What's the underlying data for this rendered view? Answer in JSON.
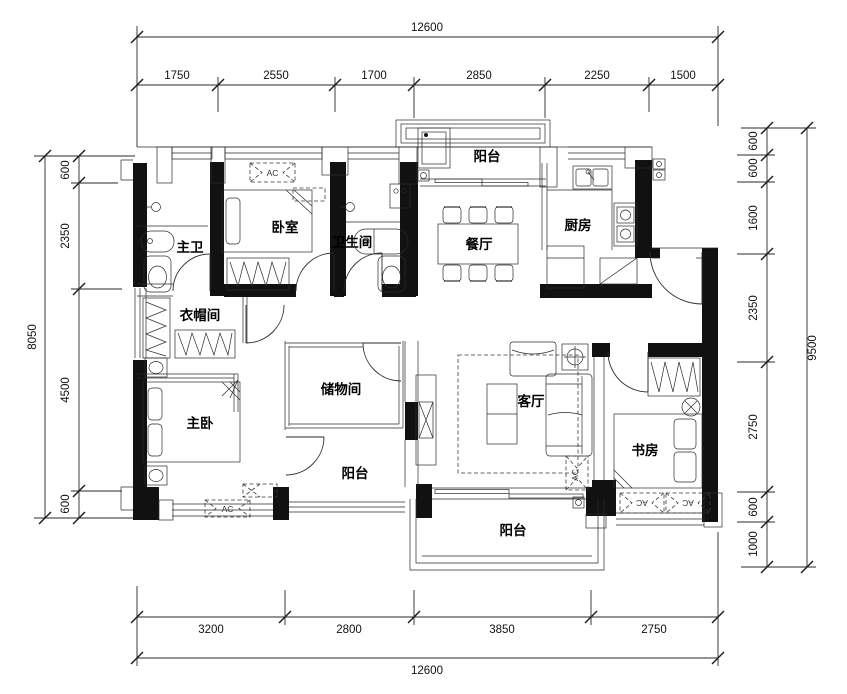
{
  "plan": {
    "rooms": {
      "balcony_top": "阳台",
      "bedroom": "卧室",
      "master_bath": "主卫",
      "bathroom": "卫生间",
      "dining": "餐厅",
      "kitchen": "厨房",
      "cloakroom": "衣帽间",
      "storage": "储物间",
      "master_bedroom": "主卧",
      "balcony_mid": "阳台",
      "living": "客厅",
      "study": "书房",
      "balcony_bottom": "阳台"
    },
    "ac_label": "AC",
    "dims": {
      "top": {
        "total": "12600",
        "segments": [
          "1750",
          "2550",
          "1700",
          "2850",
          "2250",
          "1500"
        ]
      },
      "bottom": {
        "total": "12600",
        "segments": [
          "3200",
          "2800",
          "3850",
          "2750"
        ]
      },
      "left": {
        "total": "8050",
        "segments": [
          "600",
          "2350",
          "4500",
          "600"
        ]
      },
      "right": {
        "total": "9500",
        "segments": [
          "600",
          "600",
          "1600",
          "2350",
          "2750",
          "600",
          "1000"
        ]
      }
    },
    "colors": {
      "line": "#1a1a1a",
      "background": "#ffffff"
    }
  }
}
